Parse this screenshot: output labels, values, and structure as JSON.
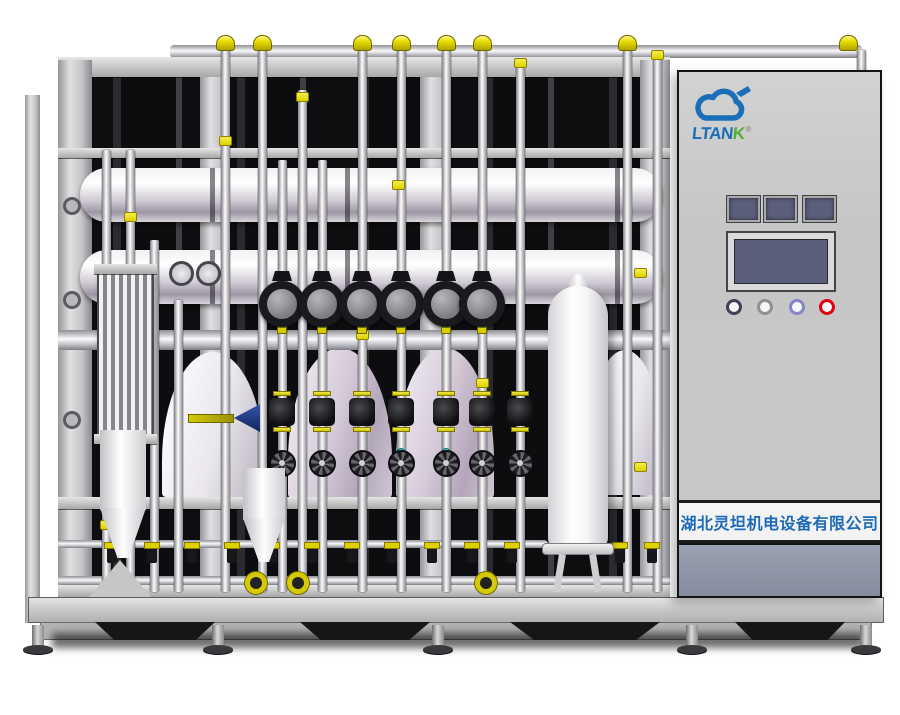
{
  "image": {
    "description": "3D product render of a stainless-steel purified water treatment skid with piping, diaphragm valves, membrane housings, storage tank and an electrical control cabinet",
    "background": "#ffffff"
  },
  "cabinet": {
    "brand": {
      "text_blue": "LTAN",
      "text_green": "K",
      "registered_mark": "®",
      "logo_blue": "#1b6fb8",
      "logo_green": "#55b02e"
    },
    "company_plate": {
      "text": "湖北灵坦机电设备有限公司",
      "text_color": "#1a6ab8"
    },
    "panel": {
      "window_xs": [
        48,
        85,
        124
      ],
      "window_color": "#5c5f7b",
      "screen_color": "#5c5f7b",
      "button_cy": 235,
      "buttons": [
        {
          "cx": 55,
          "ring": "#3f3f58"
        },
        {
          "cx": 86,
          "ring": "#909090"
        },
        {
          "cx": 118,
          "ring": "#8585c8"
        },
        {
          "cx": 148,
          "ring": "#e3000e"
        }
      ]
    },
    "body_color": "#c8c8c8",
    "lower_panel_color": "#8b93a3"
  },
  "scene": {
    "palette": {
      "accent_yellow": "#e8dc00",
      "pipe_light": "#fdfdfd",
      "pipe_dark": "#85858b",
      "vessel_lavender": "#cdc2d2",
      "frame_gray": "#c9c9c9",
      "shadow_black": "#121212",
      "teal": "#3cc9c9"
    },
    "vertical_pipes": [
      {
        "x": 106,
        "top": 150,
        "bottom": 592
      },
      {
        "x": 130,
        "top": 150,
        "bottom": 592
      },
      {
        "x": 154,
        "top": 240,
        "bottom": 592
      },
      {
        "x": 178,
        "top": 300,
        "bottom": 592
      },
      {
        "x": 225,
        "top": 38,
        "bottom": 592
      },
      {
        "x": 262,
        "top": 38,
        "bottom": 592
      },
      {
        "x": 282,
        "top": 160,
        "bottom": 592
      },
      {
        "x": 302,
        "top": 90,
        "bottom": 592
      },
      {
        "x": 322,
        "top": 160,
        "bottom": 592
      },
      {
        "x": 362,
        "top": 38,
        "bottom": 592
      },
      {
        "x": 401,
        "top": 38,
        "bottom": 592
      },
      {
        "x": 446,
        "top": 38,
        "bottom": 592
      },
      {
        "x": 482,
        "top": 38,
        "bottom": 592
      },
      {
        "x": 520,
        "top": 60,
        "bottom": 592
      },
      {
        "x": 627,
        "top": 38,
        "bottom": 592
      },
      {
        "x": 657,
        "top": 55,
        "bottom": 592
      },
      {
        "x": 861,
        "top": 50,
        "bottom": 72
      }
    ],
    "top_elbows": [
      225,
      262,
      362,
      401,
      446,
      482,
      627,
      848
    ],
    "yellow_bits": [
      [
        302,
        92
      ],
      [
        225,
        136
      ],
      [
        130,
        212
      ],
      [
        398,
        180
      ],
      [
        640,
        268
      ],
      [
        520,
        58
      ],
      [
        657,
        50
      ],
      [
        106,
        520
      ],
      [
        482,
        378
      ],
      [
        362,
        330
      ],
      [
        640,
        462
      ]
    ],
    "ports": [
      [
        72,
        206
      ],
      [
        72,
        300
      ],
      [
        72,
        420
      ]
    ],
    "gauges": [
      [
        181,
        273
      ],
      [
        208,
        273
      ]
    ],
    "clamp_valves": [
      282,
      322,
      362,
      401,
      446,
      482
    ],
    "clamp_cy": 304,
    "diaphragm_valves": [
      282,
      322,
      362,
      401,
      446,
      482,
      520
    ],
    "teal_dots": [
      401,
      446
    ],
    "handwheels": [
      282,
      322,
      362,
      401,
      446,
      482,
      520
    ],
    "bottom_valves": [
      112,
      152,
      192,
      232,
      272,
      312,
      352,
      392,
      432,
      472,
      512,
      620,
      652
    ],
    "yellow_wheels": [
      256,
      298,
      486
    ],
    "yellow_wheel_cy": 583,
    "arch_vessels": [
      {
        "x": 162,
        "y": 352,
        "w": 102,
        "h": 145,
        "tone": "light"
      },
      {
        "x": 288,
        "y": 348,
        "w": 104,
        "h": 150,
        "tone": "lavender"
      },
      {
        "x": 396,
        "y": 348,
        "w": 98,
        "h": 150,
        "tone": "lavender"
      },
      {
        "x": 586,
        "y": 350,
        "w": 78,
        "h": 145,
        "tone": "light"
      }
    ],
    "skirt_shadows": [
      [
        95,
        120
      ],
      [
        300,
        130
      ],
      [
        510,
        150
      ],
      [
        735,
        110
      ]
    ],
    "feet": [
      38,
      218,
      438,
      692,
      866
    ]
  }
}
